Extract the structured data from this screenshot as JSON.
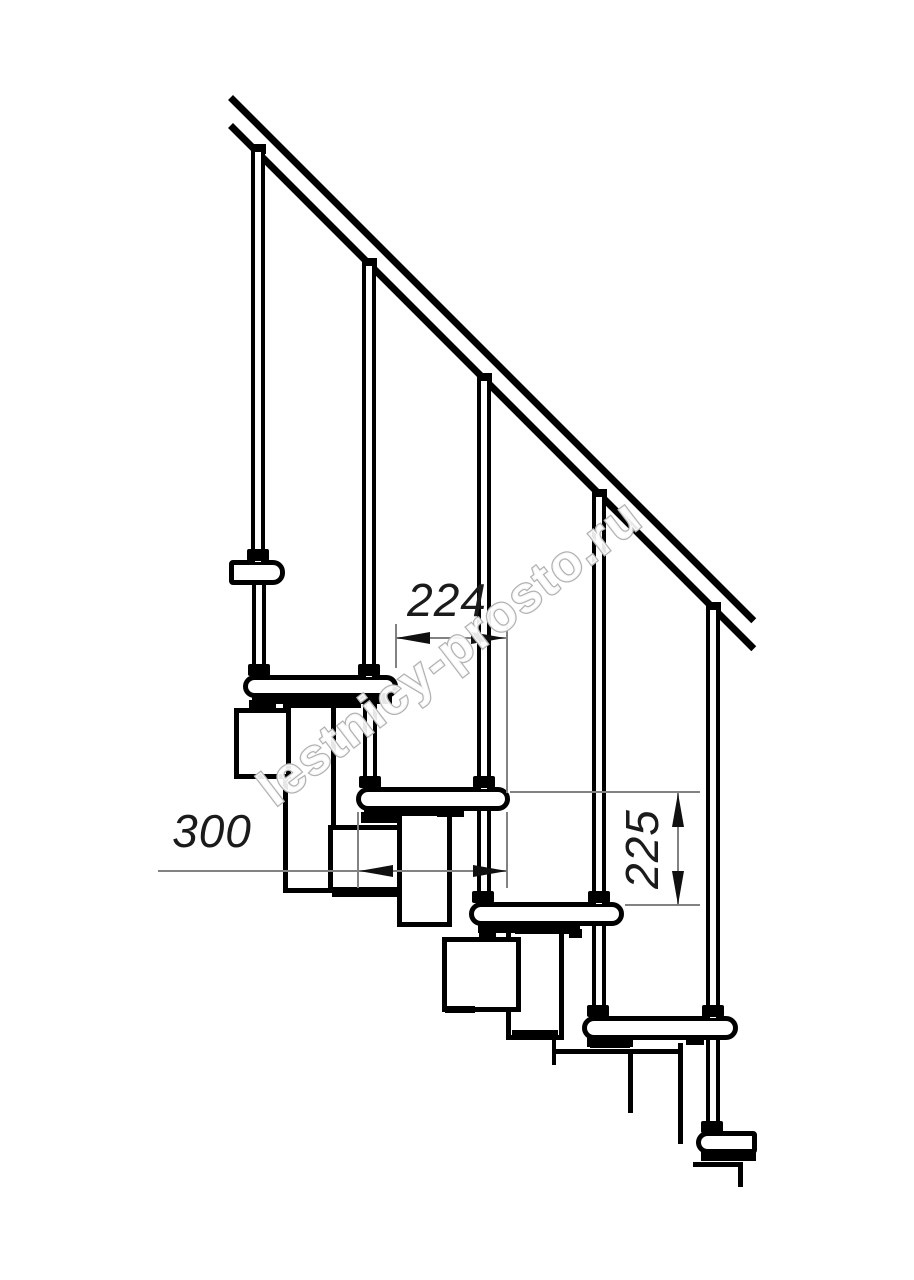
{
  "watermark": {
    "text": "lestnicy-prosto.ru"
  },
  "dimensions": {
    "going": {
      "value": "224",
      "orientation": "horizontal",
      "meaning": "step offset"
    },
    "tread_depth": {
      "value": "300",
      "orientation": "horizontal",
      "meaning": "tread depth"
    },
    "riser": {
      "value": "225",
      "orientation": "vertical",
      "meaning": "riser height"
    }
  },
  "colors": {
    "line": "#000000",
    "dim_line": "#828282",
    "dim_text": "#1b1b1b",
    "watermark_stroke": "#b2b2b2",
    "background": "#ffffff"
  },
  "elements": {
    "handrail": "sloped double-line handrail",
    "balusters": 5,
    "treads": 6,
    "support_modules": "zig-zag modular stringer boxes"
  }
}
